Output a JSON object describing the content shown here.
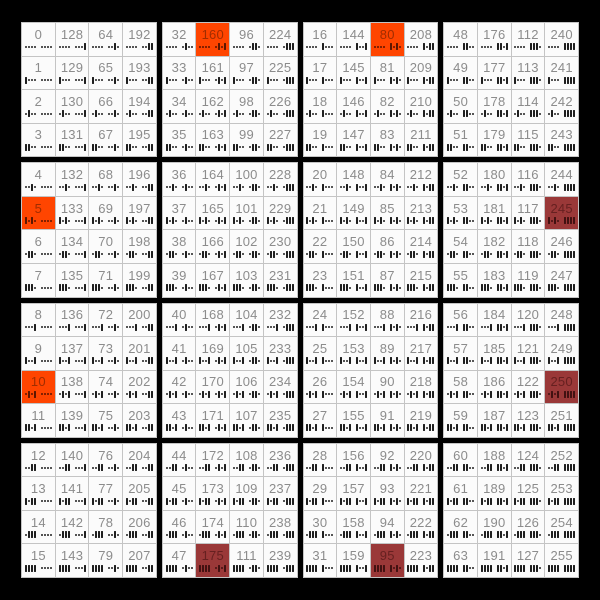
{
  "colors": {
    "background": "#000000",
    "cell_bg": "#fbfbfb",
    "cell_border": "#c4c4c4",
    "number_text": "#8c8c8c",
    "mark": "#1f1f1f"
  },
  "chart_data": {
    "type": "table",
    "title": "",
    "description": "16x16 grid of values 0-255; columns ordered by 4-bit bit-reversal (value = row + 16*bitrev(col)); each cell shows the decimal value above its 8-bit binary pattern, least-significant bit first, dot = 0, bar = 1, grouped in nibbles",
    "rows": [
      [
        0,
        128,
        64,
        192,
        32,
        160,
        96,
        224,
        16,
        144,
        80,
        208,
        48,
        176,
        112,
        240
      ],
      [
        1,
        129,
        65,
        193,
        33,
        161,
        97,
        225,
        17,
        145,
        81,
        209,
        49,
        177,
        113,
        241
      ],
      [
        2,
        130,
        66,
        194,
        34,
        162,
        98,
        226,
        18,
        146,
        82,
        210,
        50,
        178,
        114,
        242
      ],
      [
        3,
        131,
        67,
        195,
        35,
        163,
        99,
        227,
        19,
        147,
        83,
        211,
        51,
        179,
        115,
        243
      ],
      [
        4,
        132,
        68,
        196,
        36,
        164,
        100,
        228,
        20,
        148,
        84,
        212,
        52,
        180,
        116,
        244
      ],
      [
        5,
        133,
        69,
        197,
        37,
        165,
        101,
        229,
        21,
        149,
        85,
        213,
        53,
        181,
        117,
        245
      ],
      [
        6,
        134,
        70,
        198,
        38,
        166,
        102,
        230,
        22,
        150,
        86,
        214,
        54,
        182,
        118,
        246
      ],
      [
        7,
        135,
        71,
        199,
        39,
        167,
        103,
        231,
        23,
        151,
        87,
        215,
        55,
        183,
        119,
        247
      ],
      [
        8,
        136,
        72,
        200,
        40,
        168,
        104,
        232,
        24,
        152,
        88,
        216,
        56,
        184,
        120,
        248
      ],
      [
        9,
        137,
        73,
        201,
        41,
        169,
        105,
        233,
        25,
        153,
        89,
        217,
        57,
        185,
        121,
        249
      ],
      [
        10,
        138,
        74,
        202,
        42,
        170,
        106,
        234,
        26,
        154,
        90,
        218,
        58,
        186,
        122,
        250
      ],
      [
        11,
        139,
        75,
        203,
        43,
        171,
        107,
        235,
        27,
        155,
        91,
        219,
        59,
        187,
        123,
        251
      ],
      [
        12,
        140,
        76,
        204,
        44,
        172,
        108,
        236,
        28,
        156,
        92,
        220,
        60,
        188,
        124,
        252
      ],
      [
        13,
        141,
        77,
        205,
        45,
        173,
        109,
        237,
        29,
        157,
        93,
        221,
        61,
        189,
        125,
        253
      ],
      [
        14,
        142,
        78,
        206,
        46,
        174,
        110,
        238,
        30,
        158,
        94,
        222,
        62,
        190,
        126,
        254
      ],
      [
        15,
        143,
        79,
        207,
        47,
        175,
        111,
        239,
        31,
        159,
        95,
        223,
        63,
        191,
        127,
        255
      ]
    ],
    "highlights": [
      {
        "value": 160,
        "row": 0,
        "col": 5,
        "style": "orange"
      },
      {
        "value": 80,
        "row": 0,
        "col": 10,
        "style": "orange"
      },
      {
        "value": 5,
        "row": 5,
        "col": 0,
        "style": "orange"
      },
      {
        "value": 245,
        "row": 5,
        "col": 15,
        "style": "maroon"
      },
      {
        "value": 10,
        "row": 10,
        "col": 0,
        "style": "orange"
      },
      {
        "value": 250,
        "row": 10,
        "col": 15,
        "style": "maroon"
      },
      {
        "value": 175,
        "row": 15,
        "col": 5,
        "style": "maroon"
      },
      {
        "value": 95,
        "row": 15,
        "col": 10,
        "style": "maroon"
      }
    ],
    "styles": {
      "orange": {
        "bg": "#ff4500",
        "num": "#a02d00",
        "marks": "#5e1600"
      },
      "maroon": {
        "bg": "#9a3838",
        "num": "#662020",
        "marks": "#421111"
      }
    },
    "layout": {
      "grid_rows": 16,
      "grid_cols": 16,
      "block_size": 4,
      "thick_separator_px": 5,
      "thin_separator_px": 1,
      "bit_order": "lsb-first",
      "zero_glyph": "dot",
      "one_glyph": "bar",
      "nibble_group": 4
    }
  }
}
